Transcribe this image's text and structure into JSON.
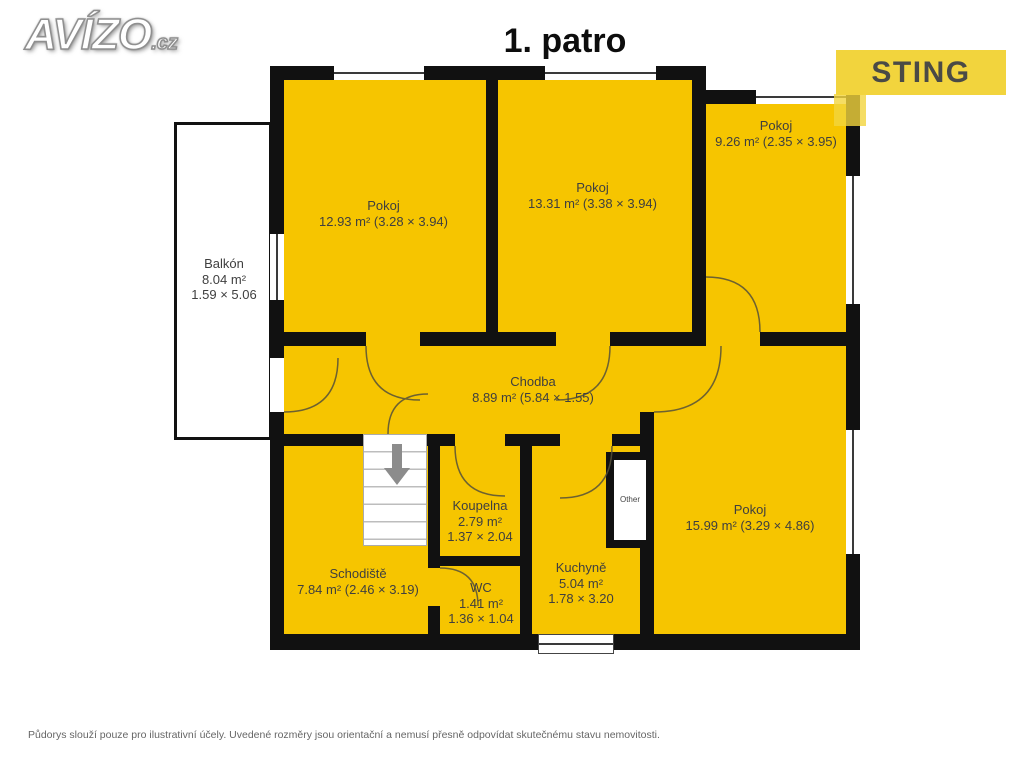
{
  "header": {
    "logo_text": "AVÍZO",
    "logo_suffix": ".cz",
    "title": "1. patro",
    "brand": "STING"
  },
  "rooms": [
    {
      "name": "Pokoj",
      "dims": "12.93 m² (3.28 × 3.94)"
    },
    {
      "name": "Pokoj",
      "dims": "13.31 m² (3.38 × 3.94)"
    },
    {
      "name": "Pokoj",
      "dims": "9.26 m² (2.35 × 3.95)"
    },
    {
      "name": "Balkón",
      "area": "8.04 m²",
      "dims": "1.59 × 5.06"
    },
    {
      "name": "Chodba",
      "dims": "8.89 m² (5.84 × 1.55)"
    },
    {
      "name": "Koupelna",
      "area": "2.79 m²",
      "dims": "1.37 × 2.04"
    },
    {
      "name": "Schodiště",
      "dims": "7.84 m² (2.46 × 3.19)"
    },
    {
      "name": "WC",
      "area": "1.41 m²",
      "dims": "1.36 × 1.04"
    },
    {
      "name": "Kuchyně",
      "area": "5.04 m²",
      "dims": "1.78 × 3.20"
    },
    {
      "name": "Pokoj",
      "dims": "15.99 m² (3.29 × 4.86)"
    },
    {
      "name": "Other"
    }
  ],
  "footer": {
    "disclaimer": "Půdorys slouží pouze pro ilustrativní účely. Uvedené rozměry jsou orientační a nemusí přesně odpovídat skutečnému stavu nemovitosti."
  },
  "colors": {
    "room_fill": "#F6C500",
    "wall": "#111111",
    "brand_yellow": "#F2D43D",
    "brand_text": "#4A4A46",
    "stairs_arrow": "#8C8C8C"
  }
}
